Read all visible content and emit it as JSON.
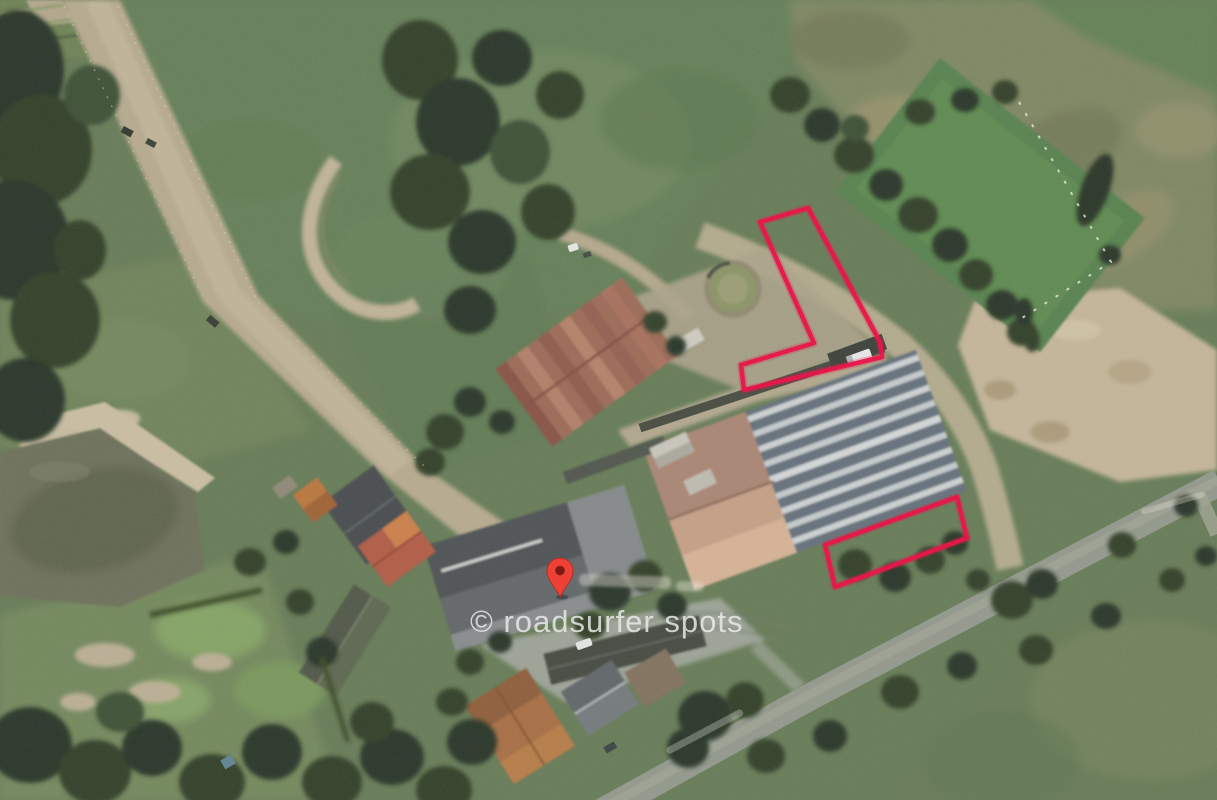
{
  "map": {
    "watermark_text": "© roadsurfer spots",
    "annotation_color": "#e6184a",
    "pin_color": "#ee4135",
    "pin_dot_color": "#7e1a12",
    "poi_label": {
      "visible": true,
      "legible": false
    },
    "street_labels": {
      "visible": true,
      "legible": false
    },
    "annotations": [
      {
        "name": "north-spot-outline",
        "shape": "L-shaped polygon"
      },
      {
        "name": "south-spot-outline",
        "shape": "rectangle"
      }
    ],
    "imagery": "satellite aerial view of a farm: fields, pond, barns, tree-lined road"
  }
}
